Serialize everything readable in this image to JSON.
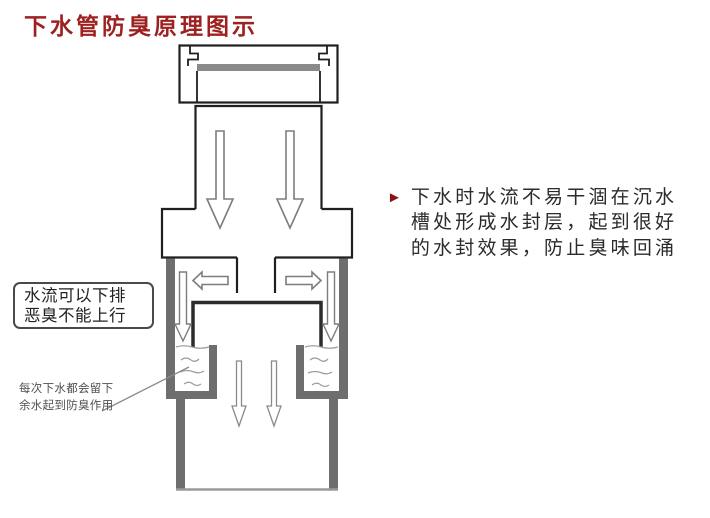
{
  "title": {
    "text": "下水管防臭原理图示",
    "color": "#9e2121"
  },
  "diagram": {
    "label_box": {
      "lines": [
        "水流可以下排",
        "恶臭不能上行"
      ]
    },
    "note": {
      "lines": [
        "每次下水都会留下",
        "余水起到防臭作用"
      ]
    },
    "colors": {
      "outline_black": "#1f1f1f",
      "wall_gray": "#6e6e6e",
      "strainer_bar_gray": "#8a8a8a",
      "arrow_outline_gray": "#7d7d7d",
      "water_line_gray": "#9e9e9e",
      "bell_dark": "#2c2c2c"
    },
    "icons": {
      "flow_down_arrows": "down-arrow",
      "flow_side_arrows": "left-right-arrows",
      "trap_water": "wavy-water-lines"
    }
  },
  "annotation": {
    "bullet": "►",
    "bullet_color": "#8c1313",
    "lines": [
      "下水时水流不易干涸在沉水",
      "槽处形成水封层，起到很好",
      "的水封效果，防止臭味回涌"
    ]
  }
}
